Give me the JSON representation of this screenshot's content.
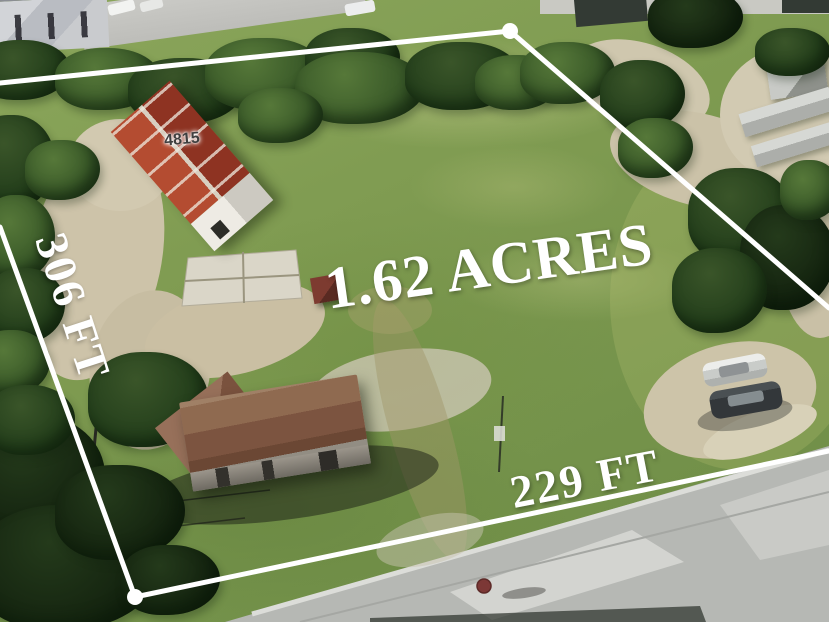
{
  "annotations": {
    "area": "1.62 ACRES",
    "side_left": "306 FT",
    "side_bottom": "229 FT",
    "building_number": "4815"
  },
  "colors": {
    "boundary": "#ffffff",
    "label": "#ffffff",
    "building_number": "#3f3f3f",
    "grass": "#7f9b51",
    "tree": "#2f4a22",
    "dirt": "#cfc5aa",
    "road": "#b7b9b5",
    "red_roof": "#a84030",
    "brown_roof": "#84604a"
  }
}
